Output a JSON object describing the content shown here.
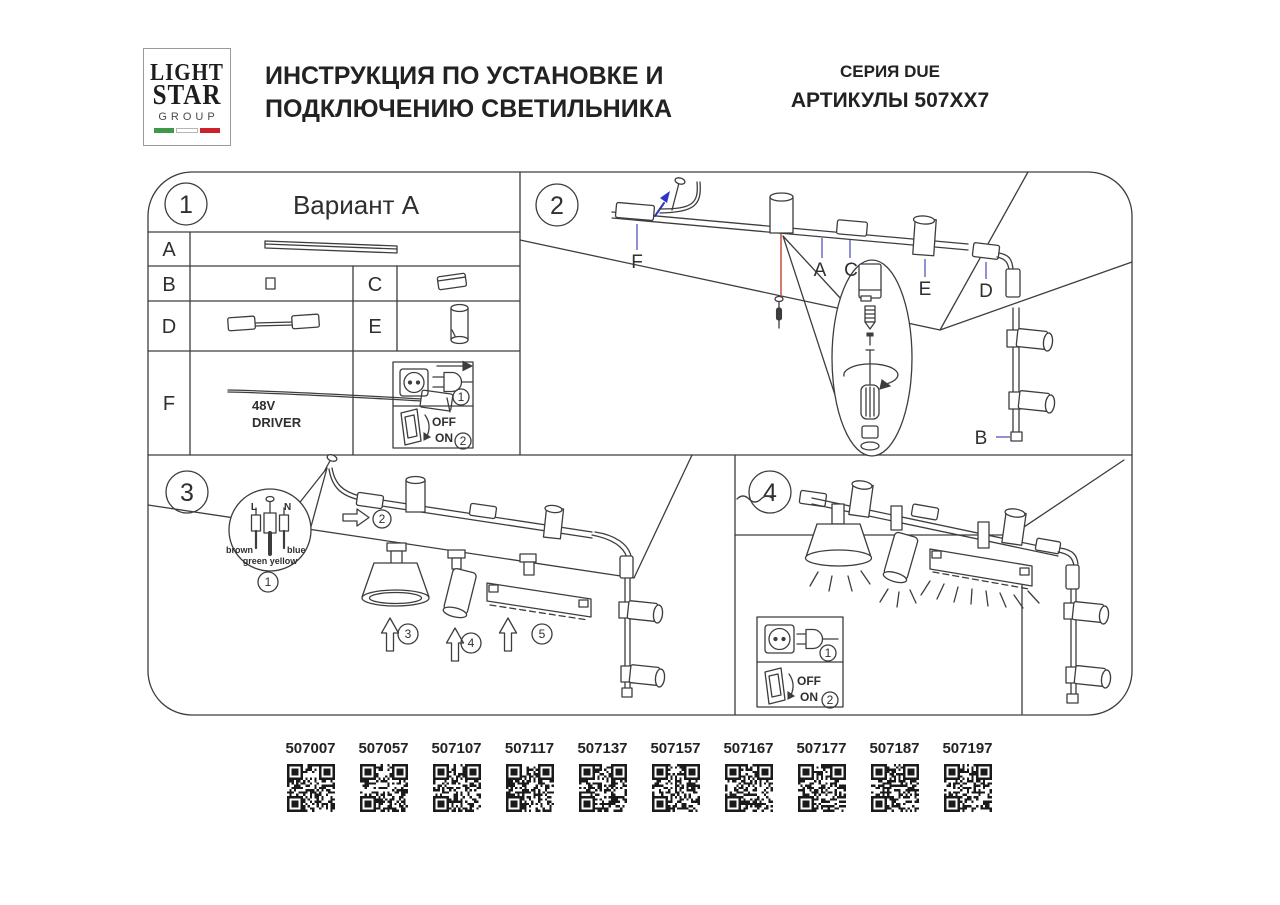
{
  "header": {
    "logo": {
      "line1": "LIGHT",
      "line2": "STAR",
      "line3": "GROUP"
    },
    "title1": "ИНСТРУКЦИЯ ПО УСТАНОВКЕ И",
    "title2": "ПОДКЛЮЧЕНИЮ СВЕТИЛЬНИКА",
    "series": "СЕРИЯ DUE",
    "articles": "АРТИКУЛЫ 507XX7"
  },
  "panel1": {
    "number": "1",
    "variant_title": "Вариант А",
    "row_a": "A",
    "row_b": "B",
    "row_c": "C",
    "row_d": "D",
    "row_e": "E",
    "row_f": "F",
    "driver_line1": "48V",
    "driver_line2": "DRIVER",
    "plug_step": "1",
    "switch_off": "OFF",
    "switch_on": "ON",
    "switch_step": "2"
  },
  "panel2": {
    "number": "2",
    "label_f": "F",
    "label_a": "A",
    "label_c": "C",
    "label_e": "E",
    "label_d": "D",
    "label_b": "B"
  },
  "panel3": {
    "number": "3",
    "wire_live": "L",
    "wire_neutral": "N",
    "wire_brown": "brown",
    "wire_blue": "blue",
    "wire_green_yellow": "green yellow",
    "step1": "1",
    "step2": "2",
    "step3": "3",
    "step4": "4",
    "step5": "5"
  },
  "panel4": {
    "number": "4",
    "plug_step": "1",
    "switch_off": "OFF",
    "switch_on": "ON",
    "switch_step": "2"
  },
  "qr": {
    "labels": [
      "507007",
      "507057",
      "507107",
      "507117",
      "507137",
      "507157",
      "507167",
      "507177",
      "507187",
      "507197"
    ]
  },
  "colors": {
    "line": "#3d3d3d",
    "leader_blue": "#6060bf",
    "arrow_blue": "#2d35c9",
    "accent_red": "#c75b4a",
    "flag_green": "#3f9948",
    "flag_red": "#cc2229"
  }
}
